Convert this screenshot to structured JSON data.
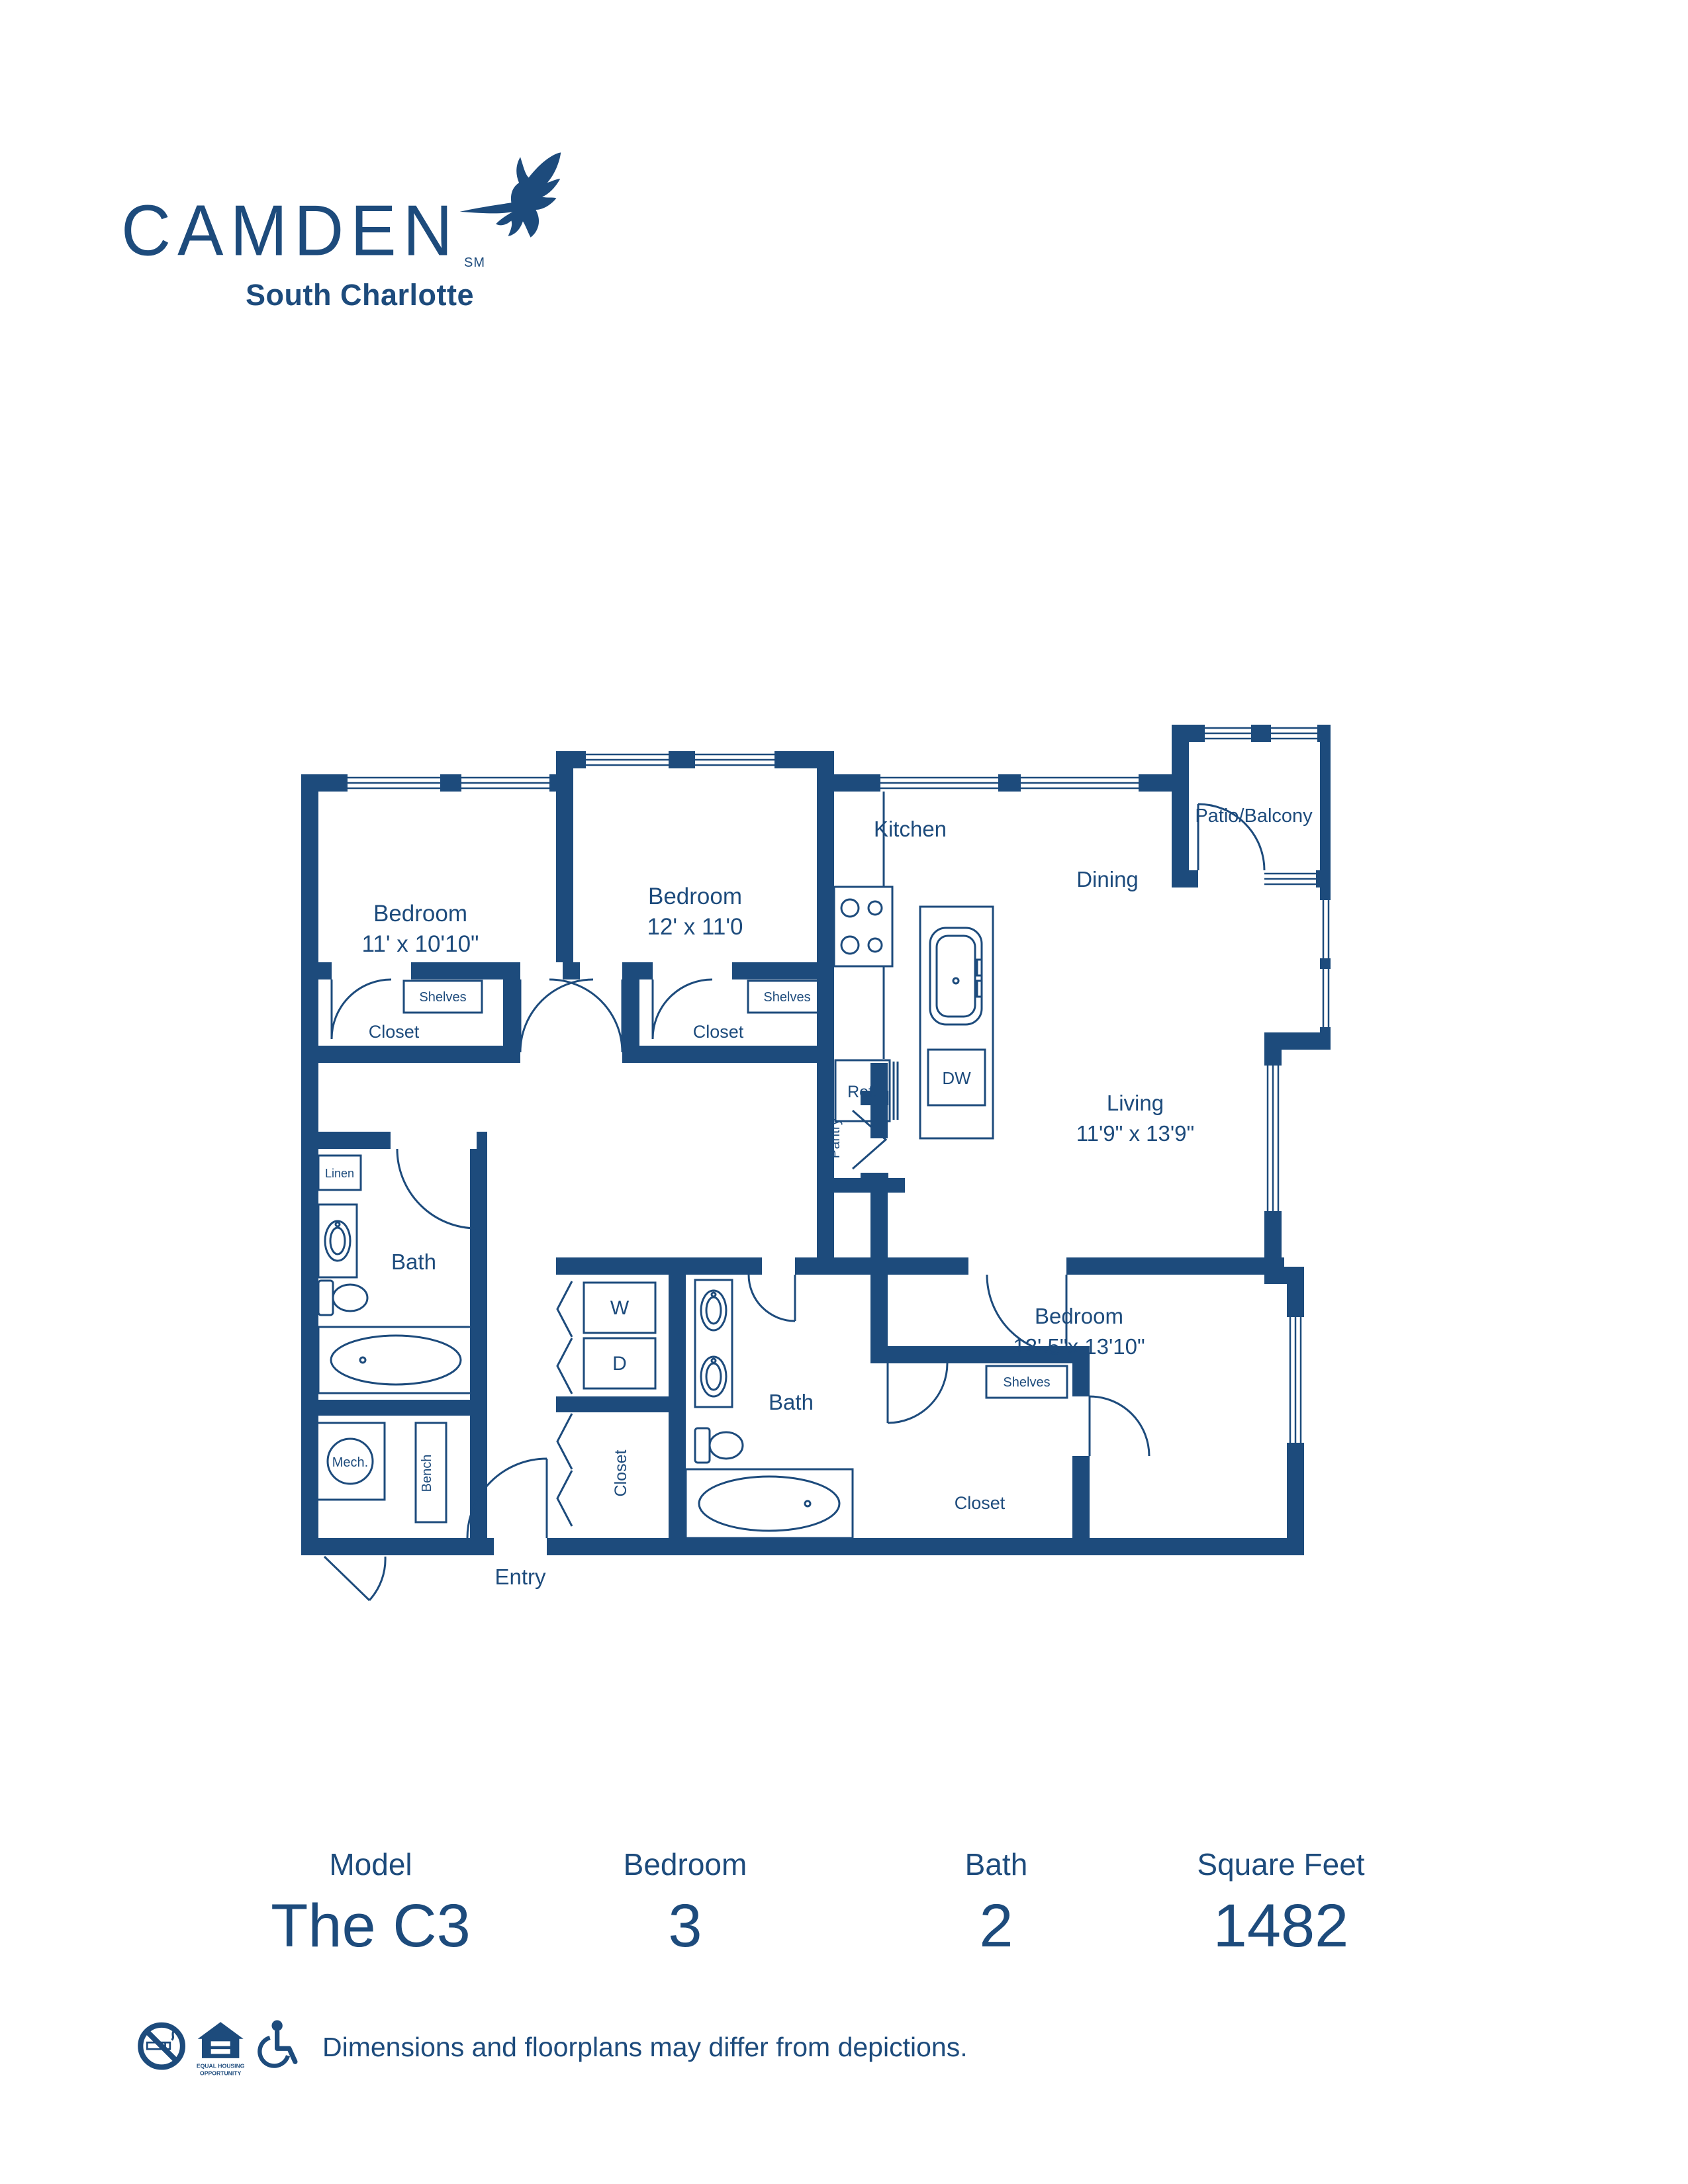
{
  "colors": {
    "navy": "#1d4b7c",
    "white": "#ffffff"
  },
  "logo": {
    "name": "CAMDEN",
    "sm": "SM",
    "property": "South Charlotte"
  },
  "plan": {
    "bedroom1": {
      "label": "Bedroom",
      "dims": "11' x 10'10\""
    },
    "bedroom2": {
      "label": "Bedroom",
      "dims": "12' x 11'0"
    },
    "bedroom3": {
      "label": "Bedroom",
      "dims": "12' 5\"x 13'10\""
    },
    "living": {
      "label": "Living",
      "dims": "11'9\" x 13'9\""
    },
    "kitchen": {
      "label": "Kitchen"
    },
    "dining": {
      "label": "Dining"
    },
    "patio": {
      "label": "Patio/Balcony"
    },
    "bath1": {
      "label": "Bath"
    },
    "bath2": {
      "label": "Bath"
    },
    "entry": {
      "label": "Entry"
    },
    "closets": {
      "bedroom1": "Closet",
      "bedroom2": "Closet",
      "bedroom3": "Closet",
      "entry": "Closet"
    },
    "shelves": {
      "bedroom1": "Shelves",
      "bedroom2": "Shelves",
      "bedroom3": "Shelves"
    },
    "fixtures": {
      "linen": "Linen",
      "pantry": "Pantry",
      "ref": "Ref.",
      "dw": "DW",
      "washer": "W",
      "dryer": "D",
      "mech": "Mech.",
      "bench": "Bench"
    }
  },
  "stats": {
    "columns": [
      {
        "label": "Model",
        "value": "The C3"
      },
      {
        "label": "Bedroom",
        "value": "3"
      },
      {
        "label": "Bath",
        "value": "2"
      },
      {
        "label": "Square Feet",
        "value": "1482"
      }
    ]
  },
  "footer": {
    "disclaimer": "Dimensions and floorplans may differ from depictions.",
    "eho_line1": "EQUAL HOUSING",
    "eho_line2": "OPPORTUNITY",
    "icons": [
      "no-smoking-icon",
      "equal-housing-opportunity-icon",
      "accessibility-icon"
    ]
  }
}
